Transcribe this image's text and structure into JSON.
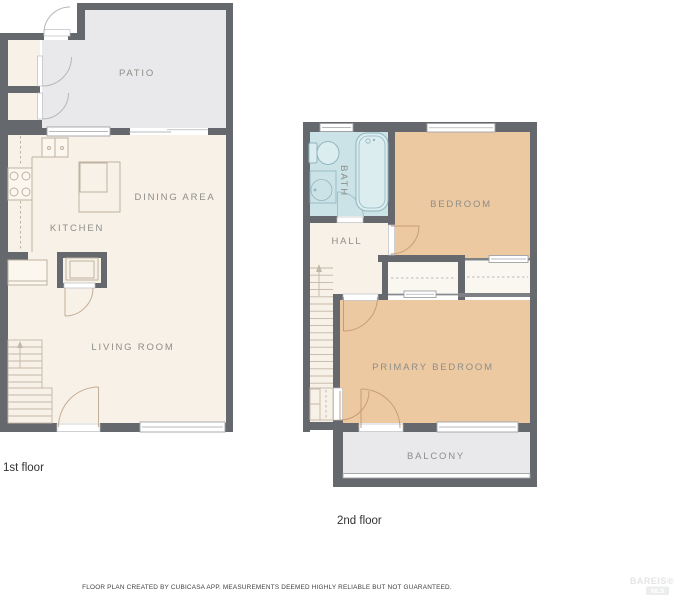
{
  "floors": [
    {
      "caption": "1st floor",
      "rooms": [
        {
          "label": "PATIO"
        },
        {
          "label": "KITCHEN"
        },
        {
          "label": "DINING AREA"
        },
        {
          "label": "LIVING ROOM"
        }
      ]
    },
    {
      "caption": "2nd floor",
      "rooms": [
        {
          "label": "BATH"
        },
        {
          "label": "BEDROOM"
        },
        {
          "label": "HALL"
        },
        {
          "label": "PRIMARY BEDROOM"
        },
        {
          "label": "BALCONY"
        }
      ]
    }
  ],
  "footer": {
    "disclaimer": "FLOOR PLAN CREATED BY CUBICASA APP. MEASUREMENTS DEEMED HIGHLY RELIABLE BUT NOT GUARANTEED."
  },
  "watermark": {
    "brand": "BAREIS®",
    "sub": "MLS"
  },
  "colors": {
    "wall": "#65686d",
    "floor_cream": "#f8f1e7",
    "outdoor_gray": "#e9e9eb",
    "bedroom_orange": "#edc9a2",
    "bath_blue": "#cbe2e7",
    "label_gray": "#8d8d89"
  }
}
